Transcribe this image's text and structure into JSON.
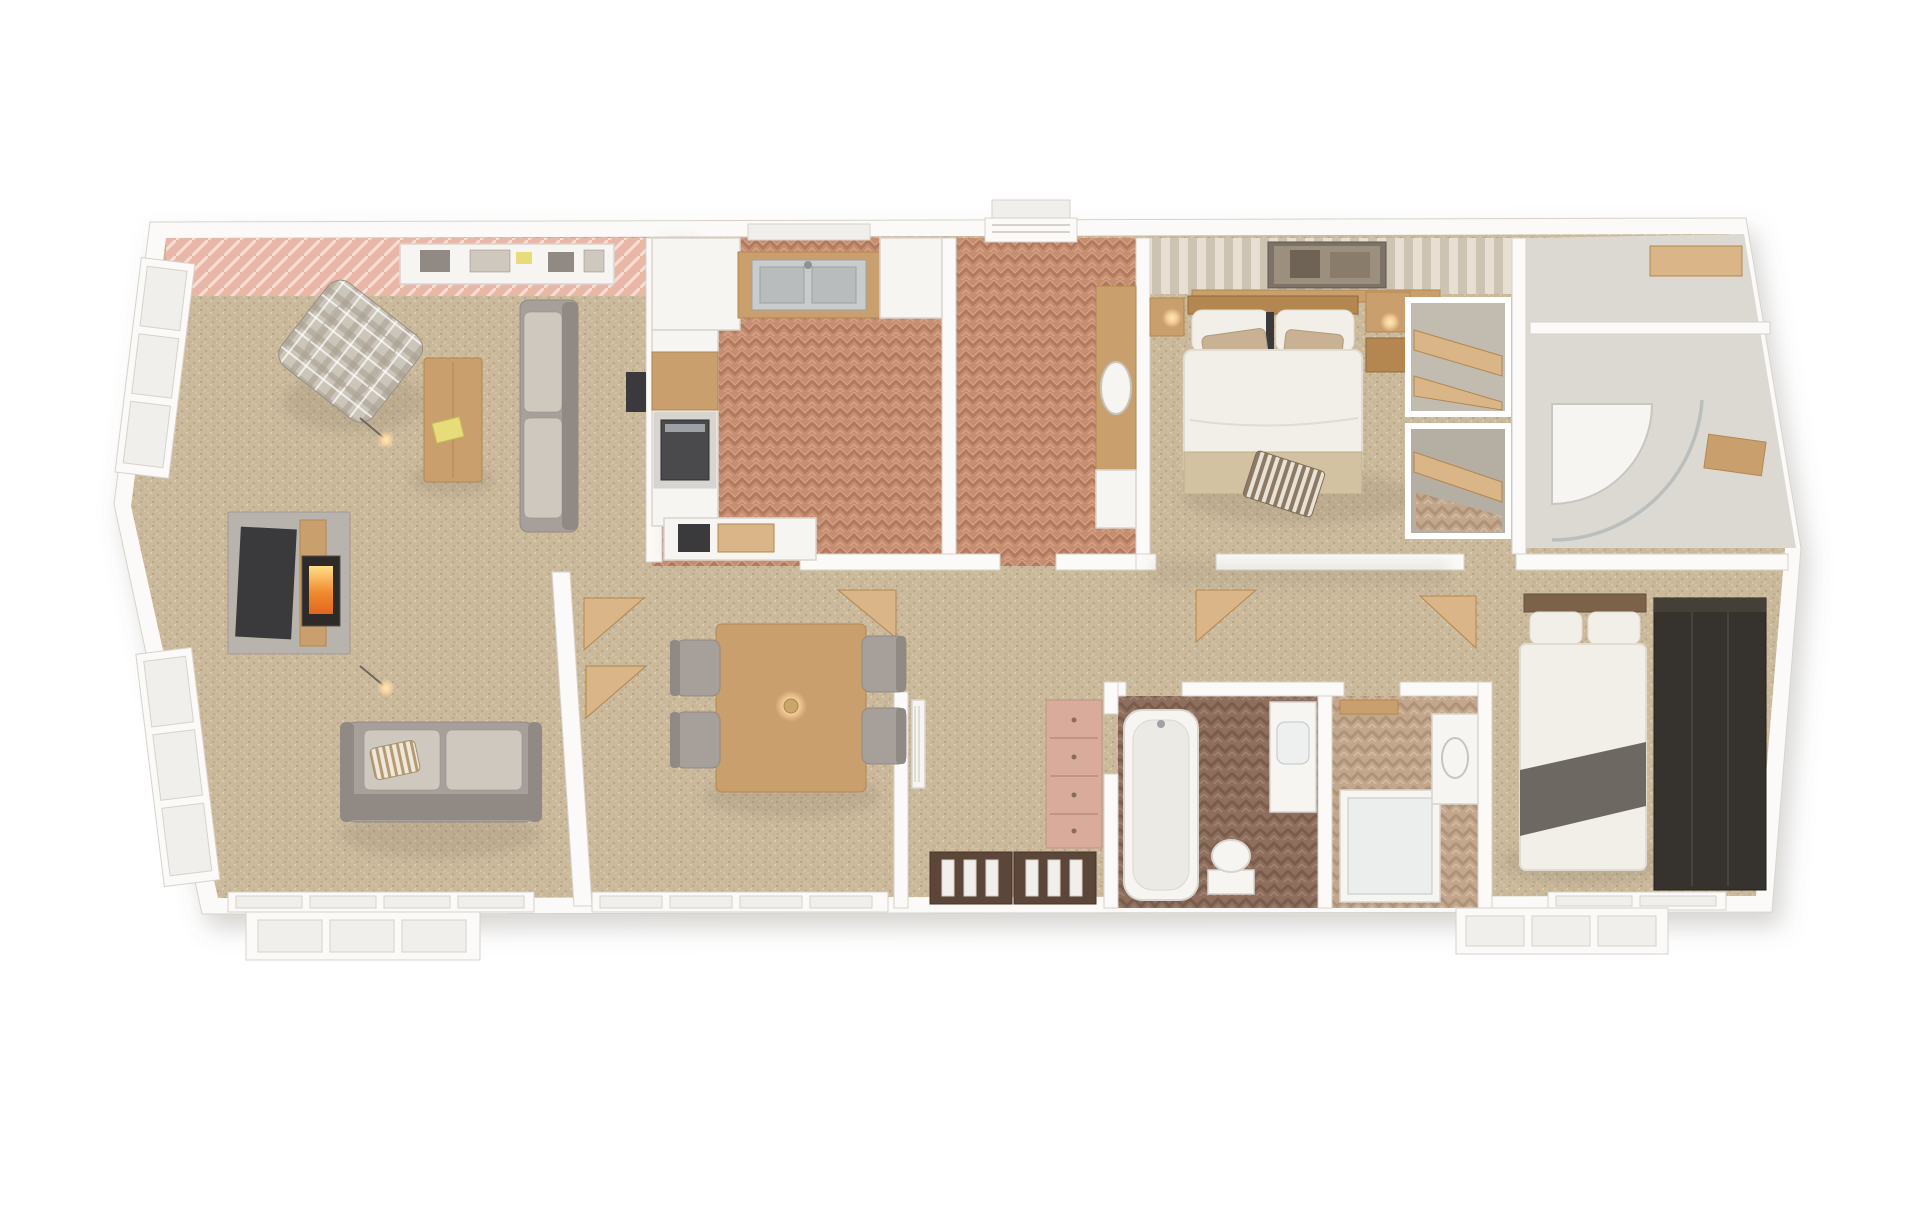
{
  "image": {
    "kind": "3d-floorplan-dollhouse-render",
    "description": "Top-down 3D architectural render of a single-storey lodge / park home, white background, no text labels",
    "background": "#ffffff"
  },
  "palette": {
    "bg": "#ffffff",
    "wall": "#fbfaf8",
    "wallEdge": "#d7d2cb",
    "glass": "#f0efec",
    "carpetBase": "#cbb99c",
    "carpetDot1": "#b9a687",
    "carpetDot2": "#dbcbae",
    "carpetDot3": "#bfae90",
    "carpetDot4": "#d5c4a6",
    "herrBase": "#c68e71",
    "herrDark": "#b1795d",
    "herrLight": "#d7a185",
    "herrDkBase": "#8e6f5e",
    "herrDkDark": "#7a5c4c",
    "herrDkLight": "#a08270",
    "herrLtBase": "#c2a78d",
    "herrLtDark": "#b09377",
    "herrLtLight": "#d2bca2",
    "deckBase": "#e9b7a8",
    "deckLine": "#f7ded4",
    "stripeA": "#e6dfd2",
    "stripeB": "#cdc3b2",
    "plaidBase": "#ccc5b9",
    "plaidBand": "#a79f91",
    "wood": "#c99f6d",
    "woodLight": "#d9b588",
    "woodDark": "#b3874f",
    "woodDarker": "#8f6a3c",
    "sofa": "#a7a09a",
    "sofaDark": "#918a84",
    "cushionLight": "#cfc8be",
    "fixture": "#f6f5f2",
    "fixtureEdge": "#d9d5cf",
    "tvDark": "#3a3a3c",
    "steel": "#c9cccd",
    "steelDark": "#9fa2a4",
    "fireGlow": "#ffb347",
    "fireCore": "#e2661f",
    "lampGlow": "#ffd9a0",
    "duvet": "#f2efe9",
    "duvetEdge": "#e0dcd4",
    "runnerGold": "#d2c2a2",
    "pillowTan": "#c9b294",
    "doorBrown": "#5c4639",
    "doorBrownEdge": "#463327",
    "chestPink": "#d8ab9a",
    "chestPinkEdge": "#c19484",
    "wardrobeDark": "#36322e",
    "wardrobeLine": "#48433d",
    "throwGray": "#6e6862",
    "tileLight": "#dcd8d2"
  },
  "floorplan": {
    "rooms": [
      {
        "name": "living-room",
        "floor": "carpet"
      },
      {
        "name": "kitchen",
        "floor": "herringbone-terracotta"
      },
      {
        "name": "utility-room",
        "floor": "herringbone-terracotta"
      },
      {
        "name": "dining-area",
        "floor": "carpet"
      },
      {
        "name": "entrance-hall",
        "floor": "carpet"
      },
      {
        "name": "corridor",
        "floor": "carpet"
      },
      {
        "name": "family-bathroom",
        "floor": "herringbone-dark"
      },
      {
        "name": "shower-room",
        "floor": "herringbone-light"
      },
      {
        "name": "master-bedroom",
        "floor": "carpet"
      },
      {
        "name": "dressing-area",
        "floor": "carpet"
      },
      {
        "name": "en-suite",
        "floor": "tile-light"
      },
      {
        "name": "second-bedroom",
        "floor": "carpet"
      }
    ],
    "furniture": [
      "plaid-armchair",
      "corner-sofa",
      "lounge-sofa",
      "coffee-table",
      "tv-media-wall",
      "log-burner",
      "floor-lamp",
      "sideboard",
      "kitchen-counter",
      "kitchen-sink",
      "oven",
      "built-in-appliance",
      "utility-counter",
      "utility-sink",
      "washing-machine",
      "dining-table",
      "dining-chair",
      "pendant-lamp",
      "corner-shelf",
      "radiator",
      "chest-of-drawers",
      "double-entrance-doors",
      "bathtub",
      "vanity-basin",
      "toilet",
      "shower-enclosure",
      "double-bed",
      "bedside-table",
      "hanging-lamp",
      "picture-frame",
      "wardrobe-shelf-unit",
      "dark-wardrobe",
      "bed-runner",
      "striped-throw",
      "porch-steps",
      "rear-door",
      "window-bay",
      "patio-windows"
    ]
  }
}
